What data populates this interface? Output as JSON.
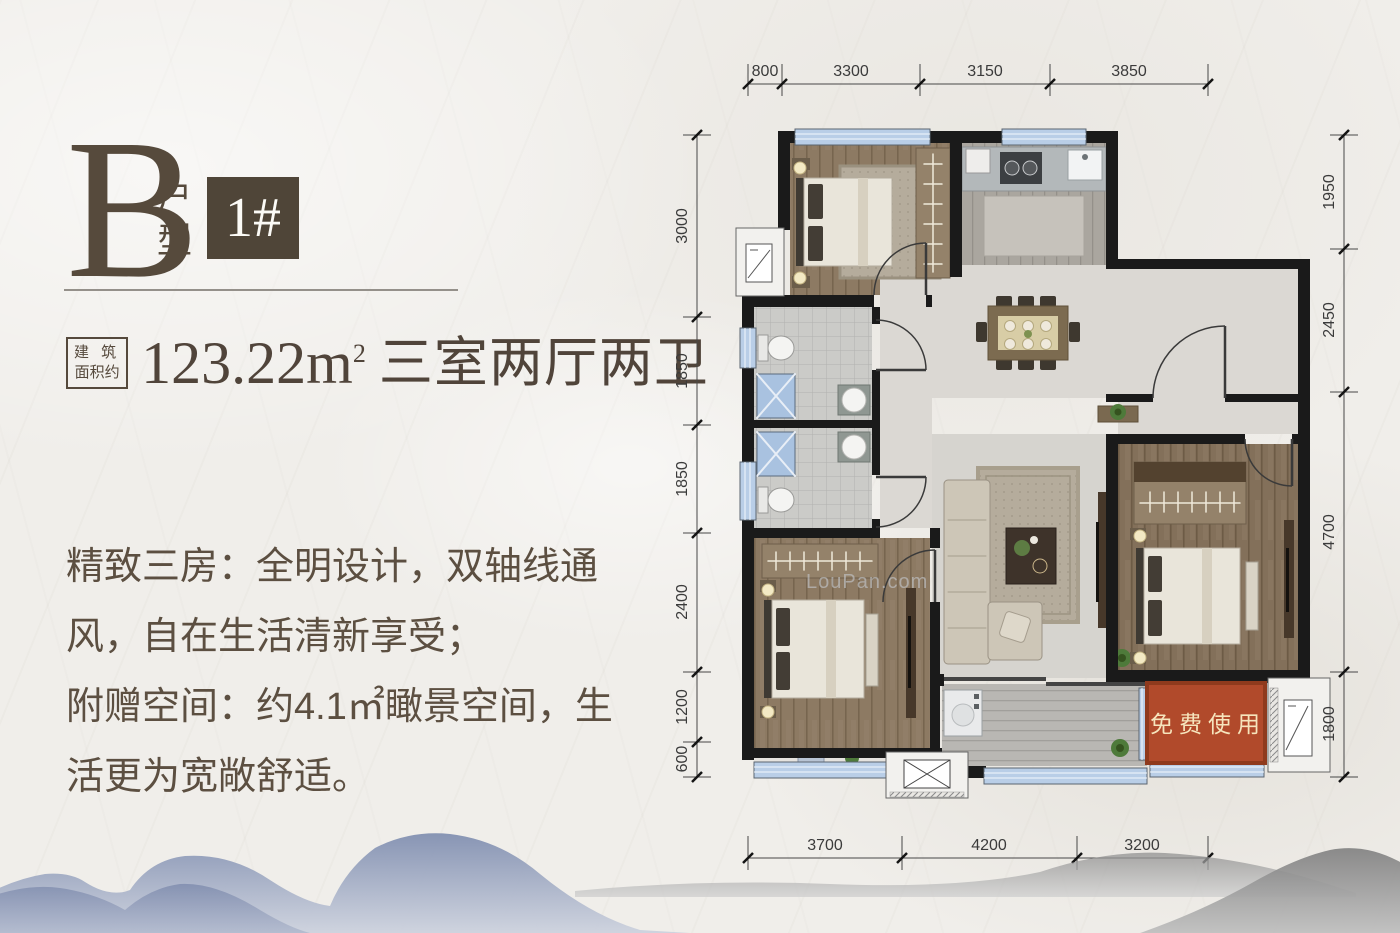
{
  "title_block": {
    "unit_letter": "B",
    "unit_type": "户型",
    "block_badge": "1#"
  },
  "area_block": {
    "label_line1": "建 筑",
    "label_line2": "面积约",
    "value": "123.22m",
    "sup": "2",
    "rooms": "三室两厅两卫"
  },
  "description_block": {
    "lines": [
      "精致三房：全明设计，双轴线通",
      "风，自在生活清新享受；",
      "附赠空间：约4.1㎡瞰景空间，生",
      "活更为宽敞舒适。"
    ]
  },
  "floor_plan": {
    "free_space_label": "免费使用",
    "watermark": "LouPan.com",
    "dimensions_top": [
      "800",
      "3300",
      "3150",
      "3850"
    ],
    "dimensions_bottom": [
      "3700",
      "4200",
      "3200"
    ],
    "dimensions_left": [
      "3000",
      "1850",
      "1850",
      "2400",
      "1200",
      "600"
    ],
    "dimensions_right": [
      "1950",
      "2450",
      "4700",
      "1800"
    ]
  },
  "colors": {
    "accent_red": "#b14a2b",
    "badge_brown": "#4f4538",
    "text_brown": "#55493c",
    "window_blue": "#b9cee7"
  }
}
